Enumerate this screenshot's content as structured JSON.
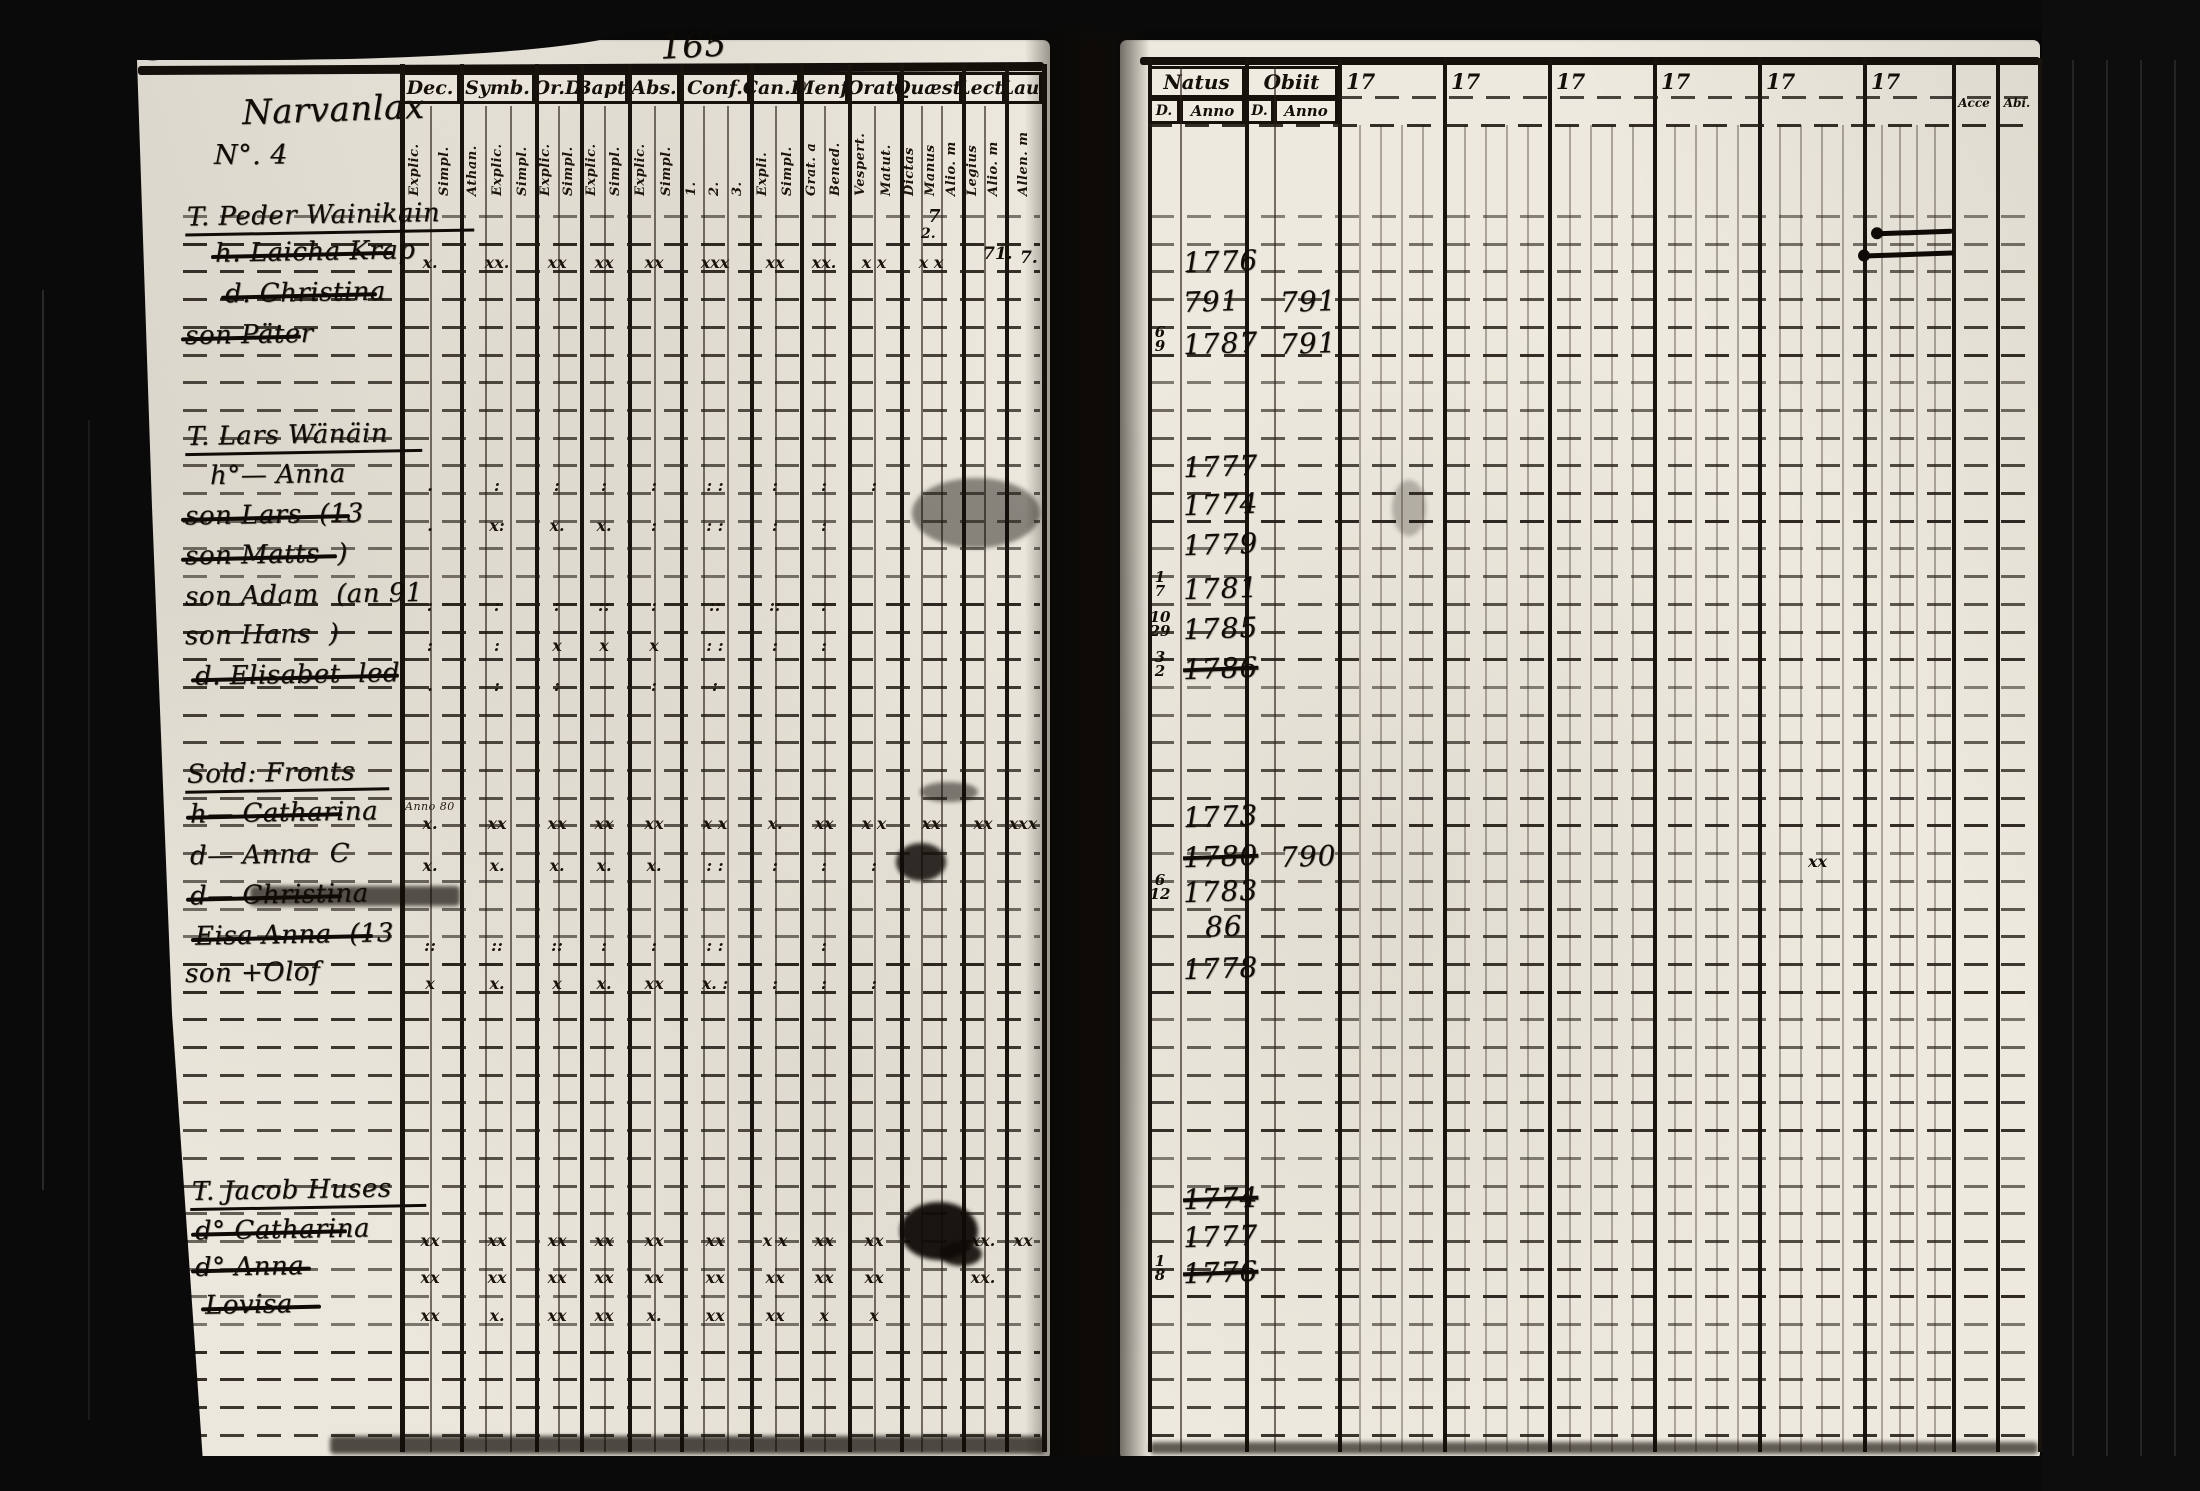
{
  "document": {
    "folio_number": "324",
    "page_number": "165",
    "village_title": "Narvanlax",
    "village_subtitle": "N°. 4"
  },
  "left_table": {
    "columns": [
      {
        "label": "Dec.",
        "subs": [
          "Explic.",
          "Simpl."
        ]
      },
      {
        "label": "Symb.",
        "subs": [
          "Athan.",
          "Explic.",
          "Simpl."
        ]
      },
      {
        "label": "Or.D",
        "subs": [
          "Explic.",
          "Simpl."
        ]
      },
      {
        "label": "Bapt.",
        "subs": [
          "Explic.",
          "Simpl."
        ]
      },
      {
        "label": "Abs.",
        "subs": [
          "Explic.",
          "Simpl."
        ]
      },
      {
        "label": "Conf.",
        "subs": [
          "1.",
          "2.",
          "3."
        ]
      },
      {
        "label": "Can.D",
        "subs": [
          "Expli.",
          "Simpl."
        ]
      },
      {
        "label": "Menf.",
        "subs": [
          "Grat. a",
          "Bened."
        ]
      },
      {
        "label": "Orat.",
        "subs": [
          "Vespert.",
          "Matut."
        ]
      },
      {
        "label": "Quæst.",
        "subs": [
          "Dictas",
          "Manus",
          "Alio. m"
        ]
      },
      {
        "label": "Lect.",
        "subs": [
          "Legius",
          "Alio. m"
        ]
      },
      {
        "label": "Lau.",
        "subs": [
          "Allen. m"
        ]
      }
    ]
  },
  "right_table": {
    "natus_label": "Natus",
    "obiit_label": "Obiit",
    "day_label": "D.",
    "anno_label": "Anno",
    "year_headers": [
      "17",
      "17",
      "17",
      "17",
      "17",
      "17"
    ],
    "accessit_label": "Acce",
    "abiit_label": "Abi."
  },
  "entries": [
    {
      "x": 185,
      "y": 200,
      "prefix": "T.",
      "name": "Peder Wainikain",
      "underline": true
    },
    {
      "x": 215,
      "y": 237,
      "prefix": "h.",
      "name": "Laicha Krap",
      "struck": true,
      "ny": 245,
      "natus_anno": "1776",
      "marks": [
        "x.",
        "xx.",
        "xx",
        "xx",
        "xx",
        "xxx",
        "xx",
        "xx.",
        "x x",
        "x x",
        "",
        ""
      ]
    },
    {
      "x": 225,
      "y": 278,
      "prefix": "d.",
      "name": "Christina",
      "struck": true,
      "ny": 285,
      "natus_anno": "791",
      "obiit_anno": "791"
    },
    {
      "x": 185,
      "y": 320,
      "prefix": "son",
      "name": "Päter",
      "struck": true,
      "ny": 327,
      "natus_d": "6/9",
      "natus_anno": "1787",
      "obiit_anno": "791"
    },
    {
      "x": 185,
      "y": 420,
      "prefix": "T.",
      "name": "Lars Wänäin",
      "underline": true,
      "ny": 450,
      "natus_anno": "1777"
    },
    {
      "x": 210,
      "y": 460,
      "prefix": "h°—",
      "name": "Anna",
      "ny": 488,
      "natus_anno": "1774",
      "marks": [
        ".",
        ":",
        ":",
        ":",
        ":",
        ": :",
        ":",
        ":",
        ":",
        "",
        "",
        ""
      ]
    },
    {
      "x": 185,
      "y": 500,
      "prefix": "son",
      "name": "Lars  (13",
      "struck": true,
      "ny": 528,
      "natus_anno": "1779",
      "marks": [
        ".",
        "x:",
        "x.",
        "x.",
        ":",
        ": :",
        ":",
        ":",
        "",
        "",
        "",
        ""
      ]
    },
    {
      "x": 185,
      "y": 540,
      "prefix": "son",
      "name": "Matts  )",
      "struck": true,
      "ny": 572,
      "natus_d": "1/7",
      "natus_anno": "1781"
    },
    {
      "x": 185,
      "y": 580,
      "prefix": "son",
      "name": "Adam  (an 91",
      "ny": 612,
      "natus_d": "10/29",
      "natus_anno": "1785",
      "marks": [
        ":",
        ":",
        ":",
        "::",
        ":",
        "::",
        "::",
        ":",
        "",
        "",
        "",
        ""
      ]
    },
    {
      "x": 185,
      "y": 620,
      "prefix": "son",
      "name": "Hans  )",
      "ny": 652,
      "natus_d": "3/2",
      "natus_anno": "1786",
      "natus_struck": true,
      "marks": [
        ":",
        ":",
        "x",
        "x",
        "x",
        ": :",
        ":",
        ":",
        "",
        "",
        "",
        ""
      ]
    },
    {
      "x": 195,
      "y": 660,
      "prefix": "d.",
      "name": "Elisabet  led",
      "struck": true,
      "marks": [
        ".",
        ":",
        ":",
        "",
        ":",
        ":",
        "",
        "",
        "",
        "",
        "",
        ""
      ]
    },
    {
      "x": 185,
      "y": 758,
      "prefix": "",
      "name": "Sold: Fronts",
      "underline": true
    },
    {
      "x": 190,
      "y": 798,
      "prefix": "h—",
      "name": "Catharina",
      "struck": true,
      "note": "Anno 80",
      "ny": 800,
      "natus_anno": "1773",
      "marks": [
        "x.",
        "xx",
        "xx",
        "xx",
        "xx",
        "x x",
        "x.",
        "xx",
        "x x",
        "xx",
        "xx",
        "xxx"
      ]
    },
    {
      "x": 190,
      "y": 840,
      "prefix": "d—",
      "name": "Anna  C",
      "ny": 840,
      "natus_anno": "1780",
      "natus_struck": true,
      "obiit_anno": "790",
      "marks": [
        "x.",
        "x.",
        "x.",
        "x.",
        "x.",
        ": :",
        ":",
        ":",
        ":",
        "",
        "",
        ""
      ]
    },
    {
      "x": 190,
      "y": 880,
      "prefix": "d—",
      "name": "Christina",
      "struck": true,
      "heavy": true,
      "ny": 875,
      "natus_d": "6/12",
      "natus_anno": "1783"
    },
    {
      "x": 195,
      "y": 920,
      "prefix": "",
      "name": "Eisa Anna  (13",
      "struck": true,
      "ny": 910,
      "natus_anno": "86",
      "nx": 1205,
      "marks": [
        "::",
        "::",
        "::",
        ":",
        ":",
        ": :",
        "",
        ":",
        "",
        "",
        "",
        ""
      ]
    },
    {
      "x": 185,
      "y": 958,
      "prefix": "son",
      "name": "+Olof",
      "ny": 952,
      "natus_anno": "1778",
      "marks": [
        "x",
        "x.",
        "x",
        "x.",
        "xx",
        "x. :",
        ":",
        ":",
        ":",
        "",
        "",
        ""
      ]
    },
    {
      "x": 190,
      "y": 1175,
      "prefix": "T.",
      "name": "Jacob Huses",
      "underline": true,
      "ny": 1182,
      "natus_anno": "1774",
      "natus_struck": true
    },
    {
      "x": 195,
      "y": 1215,
      "prefix": "d°",
      "name": "Catharina",
      "struck": true,
      "ny": 1220,
      "natus_anno": "1777",
      "marks": [
        "xx",
        "xx",
        "xx",
        "xx",
        "xx",
        "xx",
        "x x",
        "xx",
        "xx",
        "",
        "xx.",
        "xx"
      ]
    },
    {
      "x": 195,
      "y": 1252,
      "prefix": "d°",
      "name": "Anna",
      "struck": true,
      "ny": 1256,
      "natus_d": "1/8",
      "natus_anno": "1776",
      "natus_struck": true,
      "marks": [
        "xx",
        "xx",
        "xx",
        "xx",
        "xx",
        "xx",
        "xx",
        "xx",
        "xx",
        "",
        "xx.",
        ""
      ]
    },
    {
      "x": 205,
      "y": 1290,
      "prefix": "",
      "name": "Lovisa",
      "struck": true,
      "marks": [
        "xx",
        "x.",
        "xx",
        "xx",
        "x.",
        "xx",
        "xx",
        "x",
        "x",
        "",
        "",
        ""
      ]
    }
  ],
  "ink_marks": [
    {
      "x": 928,
      "y": 206,
      "t": "7",
      "s": 18
    },
    {
      "x": 921,
      "y": 226,
      "t": "2.",
      "s": 14
    },
    {
      "x": 983,
      "y": 244,
      "t": "71.",
      "s": 17
    },
    {
      "x": 1020,
      "y": 248,
      "t": "7.",
      "s": 17
    },
    {
      "x": 1808,
      "y": 852,
      "t": "xx",
      "s": 16
    }
  ],
  "strokes": [
    {
      "x": 1875,
      "y": 230,
      "w": 78
    },
    {
      "x": 1862,
      "y": 252,
      "w": 92
    }
  ],
  "blots": [
    {
      "x": 912,
      "y": 478,
      "w": 128,
      "h": 70,
      "o": 0.45
    },
    {
      "x": 896,
      "y": 843,
      "w": 50,
      "h": 38,
      "o": 0.85
    },
    {
      "x": 900,
      "y": 1202,
      "w": 78,
      "h": 58,
      "o": 0.95
    },
    {
      "x": 940,
      "y": 1242,
      "w": 42,
      "h": 24,
      "o": 0.9
    },
    {
      "x": 1392,
      "y": 480,
      "w": 34,
      "h": 56,
      "o": 0.25
    },
    {
      "x": 920,
      "y": 782,
      "w": 58,
      "h": 20,
      "o": 0.5
    }
  ],
  "colors": {
    "ink": "#100c07",
    "paper": "#ebe7dc",
    "scan_border": "#0a0a0a"
  }
}
